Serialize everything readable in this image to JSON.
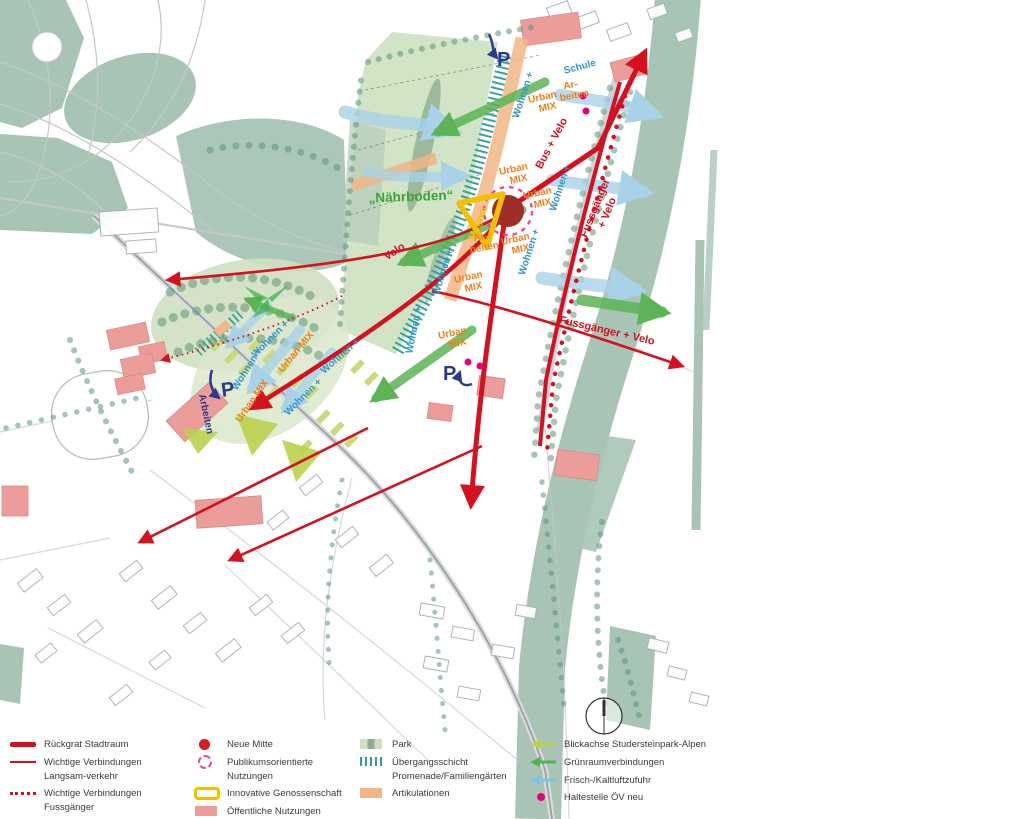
{
  "map_labels": {
    "naehrboden": "„Nährboden“",
    "magnet": "Magnet",
    "velo": "Velo",
    "bus_velo": "Bus + Velo",
    "fussgaenger": "Fussgänger",
    "plus_velo": "+ Velo",
    "fussgaenger_velo": "Fussgänger + Velo",
    "schule": "Schule",
    "ar": "Ar-",
    "beiten": "beiten",
    "arbeiten": "Arbeiten",
    "wohnen_plus": "Wohnen +",
    "urban": "Urban",
    "mix": "MIX",
    "urban_mix": "Urban MIX",
    "parking": "P"
  },
  "legend": {
    "col1": {
      "item1": "Rückgrat Stadtraum",
      "item2": "Wichtige Verbindungen Langsam-verkehr",
      "item3": "Wichtige Verbindungen Fussgänger"
    },
    "col2": {
      "item1": "Neue Mitte",
      "item2": "Publikumsorientierte Nutzungen",
      "item3": "Innovative Genossenschaft",
      "item4": "Öffentliche Nutzungen"
    },
    "col3": {
      "item1": "Park",
      "item2": "Übergangsschicht Promenade/Familiengärten",
      "item3": "Artikulationen"
    },
    "col4": {
      "item1": "Blickachse Studersteinpark-Alpen",
      "item2": "Grünraumverbindungen",
      "item3": "Frisch-/Kaltluftzufuhr",
      "item4": "Haltestelle ÖV neu"
    }
  },
  "colors": {
    "ruckgrat_red": "#d5101f",
    "neue_mitte": "#9e2f28",
    "magenta": "#e6007e",
    "publikum_pink": "#ea4a9b",
    "genossenschaft_yellow": "#f3c000",
    "oeffentlich_salmon": "#ec9d99",
    "park_green": "#d2e4c6",
    "uebergang_teal": "#2f9e9b",
    "artikulation_orange": "#f2b584",
    "blickachse_yellowgreen": "#bcd14e",
    "gruenraum_green": "#5cb454",
    "frischluft_blue": "#a8d2e8",
    "water_sage": "#a7c4b5",
    "label_blue": "#2e96cc",
    "label_orange": "#f07f1a",
    "label_navy": "#2c3a8d"
  }
}
